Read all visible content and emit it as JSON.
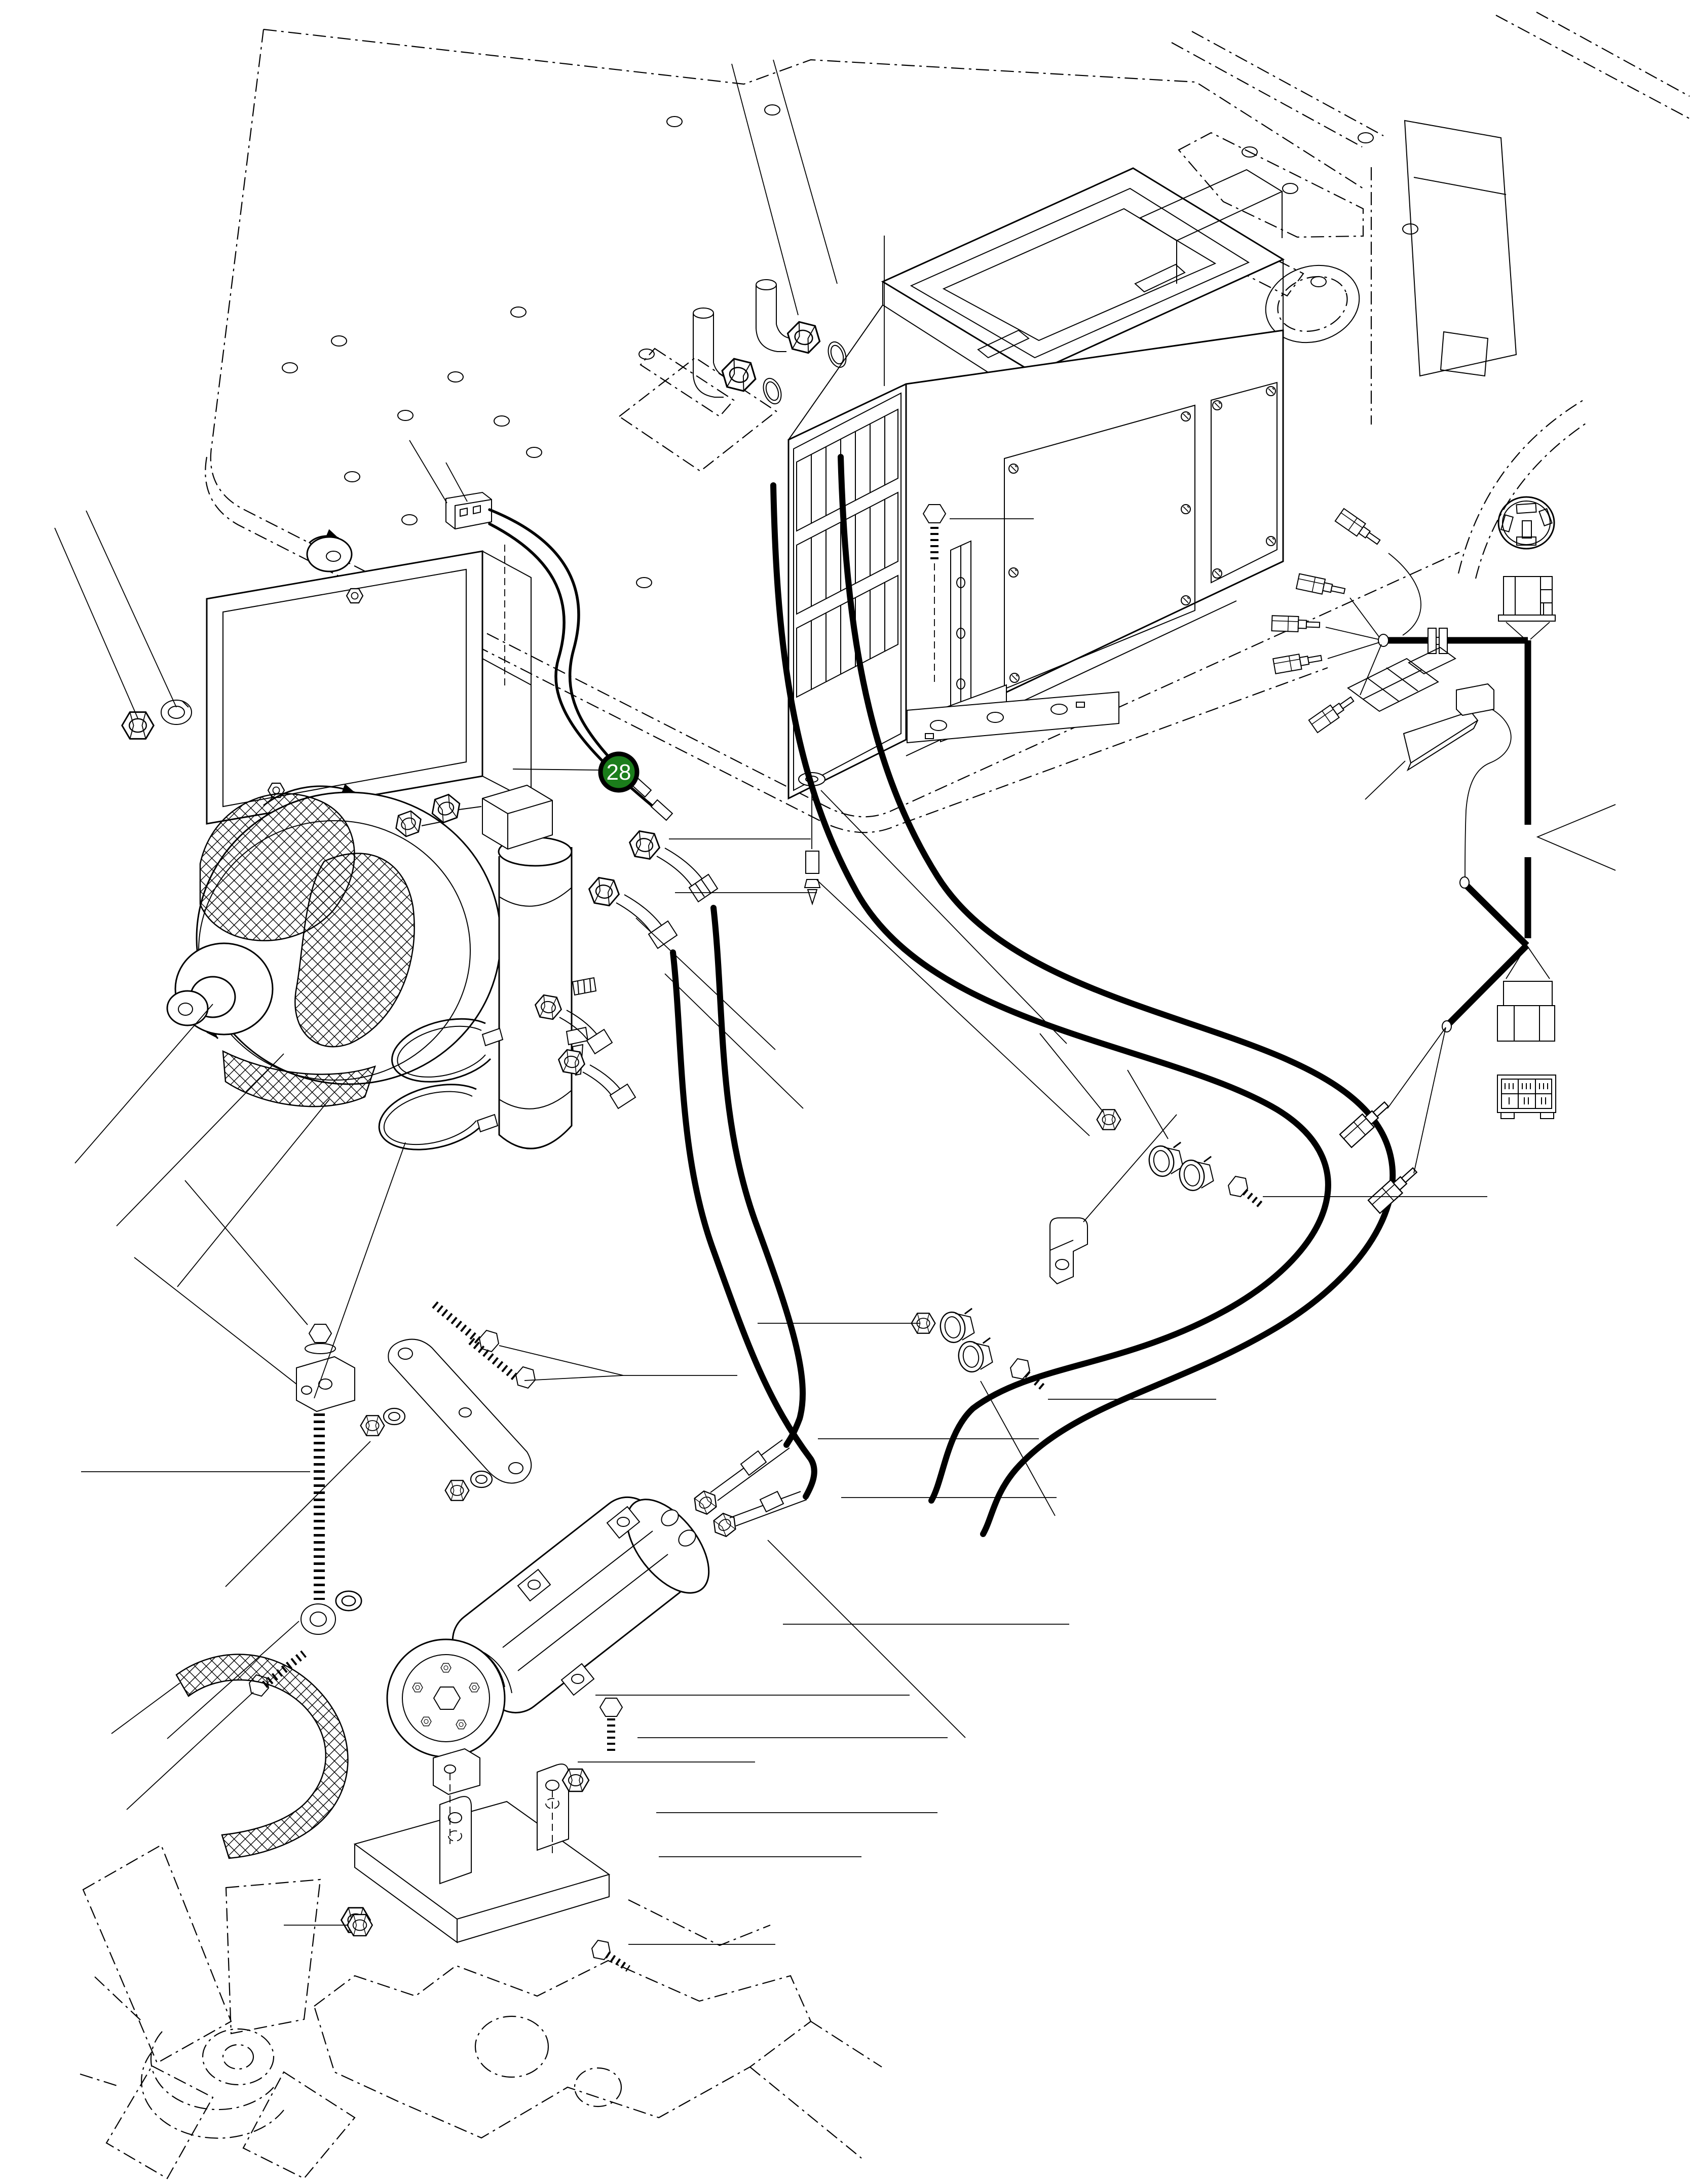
{
  "page": {
    "background": "#ffffff",
    "ink": "#000000"
  },
  "callout": {
    "label": "28",
    "fill": "#1b7d1b",
    "ring": "#000000",
    "text_color": "#ffffff"
  }
}
